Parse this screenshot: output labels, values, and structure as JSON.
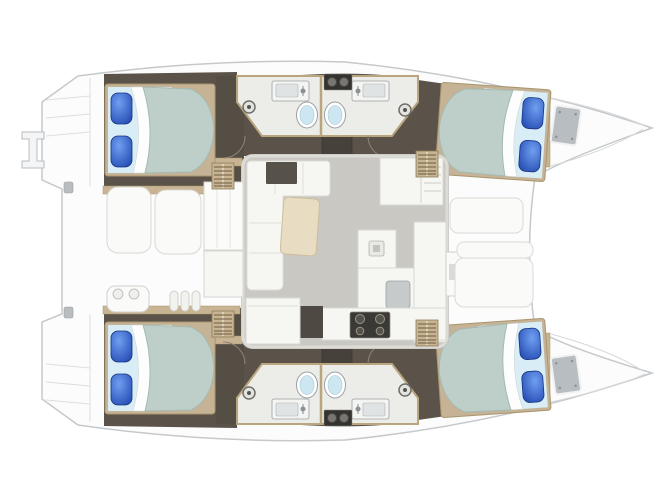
{
  "diagram": {
    "type": "boat-floor-plan",
    "vessel": "catamaran",
    "orientation": "bow-right",
    "areas": [
      {
        "id": "cabin-port-aft",
        "kind": "double-bed-cabin"
      },
      {
        "id": "cabin-port-fwd",
        "kind": "double-bed-cabin"
      },
      {
        "id": "cabin-stbd-aft",
        "kind": "double-bed-cabin"
      },
      {
        "id": "cabin-stbd-fwd",
        "kind": "double-bed-cabin"
      },
      {
        "id": "heads-port",
        "kind": "bathroom-pair"
      },
      {
        "id": "heads-stbd",
        "kind": "bathroom-pair"
      },
      {
        "id": "saloon",
        "kind": "lounge-galley"
      },
      {
        "id": "cockpit",
        "kind": "aft-deck"
      },
      {
        "id": "foredeck",
        "kind": "bow-lounge-deck"
      }
    ]
  },
  "palette": {
    "deck": "#fcfcfc",
    "hull_outline": "#c5c9cc",
    "deck_line": "#dcdee0",
    "interior_floor": "#5b5349",
    "interior_dark": "#46423b",
    "wood_trim": "#c8b492",
    "bed_frame": "#c6b295",
    "bed_frame_stroke": "#a8966f",
    "bed_sheet": "#d8edf6",
    "mattress": "#becfc9",
    "mattress_stroke": "#a3bab2",
    "pillow_light": "#6f9ff0",
    "pillow_dark": "#1d43ad",
    "pillow_stroke": "#16337f",
    "bathroom_floor": "#ecece8",
    "bathroom_trim": "#b9a67f",
    "fixture_white": "#f4f4f2",
    "fixture_stroke": "#9aa0a2",
    "toilet_water": "#cde7f2",
    "drain": "#e3e3e0",
    "saloon_floor": "#cac8c2",
    "saloon_wall": "#dddbd6",
    "furniture": "#f6f6f3",
    "furniture_stroke": "#d8d8d3",
    "table": "#e8dcc3",
    "table_stroke": "#cdbd9c",
    "appliance": "#3b3935",
    "appliance_ring": "#9b958a",
    "basin": "#c6cacb",
    "hatch": "#b7bdc0",
    "console_dark": "#56524a",
    "steps_slat": "#6b5c41",
    "cleat": "#b9bdc0"
  }
}
